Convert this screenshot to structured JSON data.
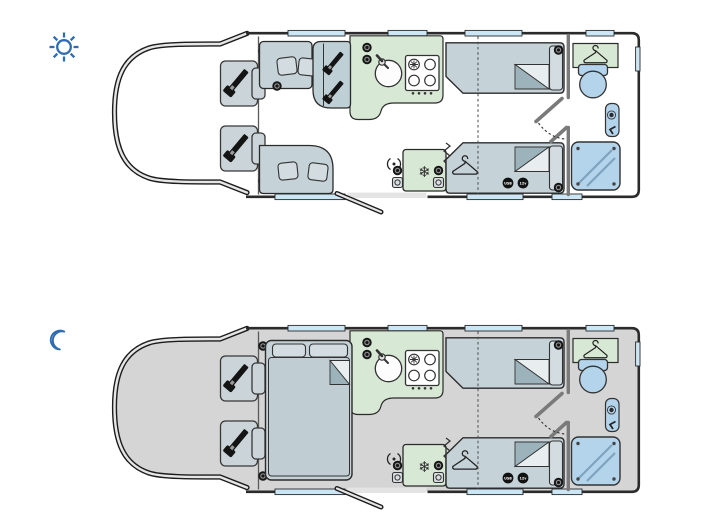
{
  "page": {
    "background": "#ffffff",
    "width": 710,
    "height": 527
  },
  "colors": {
    "page": "#ffffff",
    "accent_blue": "#2e6cb3",
    "outline": "#2b2b2b",
    "wall_gray": "#7a7a7a",
    "cab_band": "#e6e6e6",
    "floor_day": "#ffffff",
    "floor_night": "#d5d5d5",
    "furniture": "#c5d2d8",
    "furniture_light": "#d3dde1",
    "bench": "#bfcfd6",
    "seat": "#cbd5d9",
    "green": "#d7e8d4",
    "window_blue": "#cbe6f5",
    "fixture_blue": "#b4d4ec",
    "fold_dark": "#9db3bb",
    "fold_light": "#e8eef0",
    "duvet": "#c0ced4",
    "belt": "#141414",
    "threshold": "#e4e4e4"
  },
  "plans": [
    {
      "id": "day",
      "icon": "sun-icon"
    },
    {
      "id": "night",
      "icon": "moon-icon"
    }
  ],
  "icons": {
    "snowflake_glyph": "❄"
  },
  "sockets": {
    "usb_label": "USB",
    "twelve_volt_label": "12v"
  }
}
